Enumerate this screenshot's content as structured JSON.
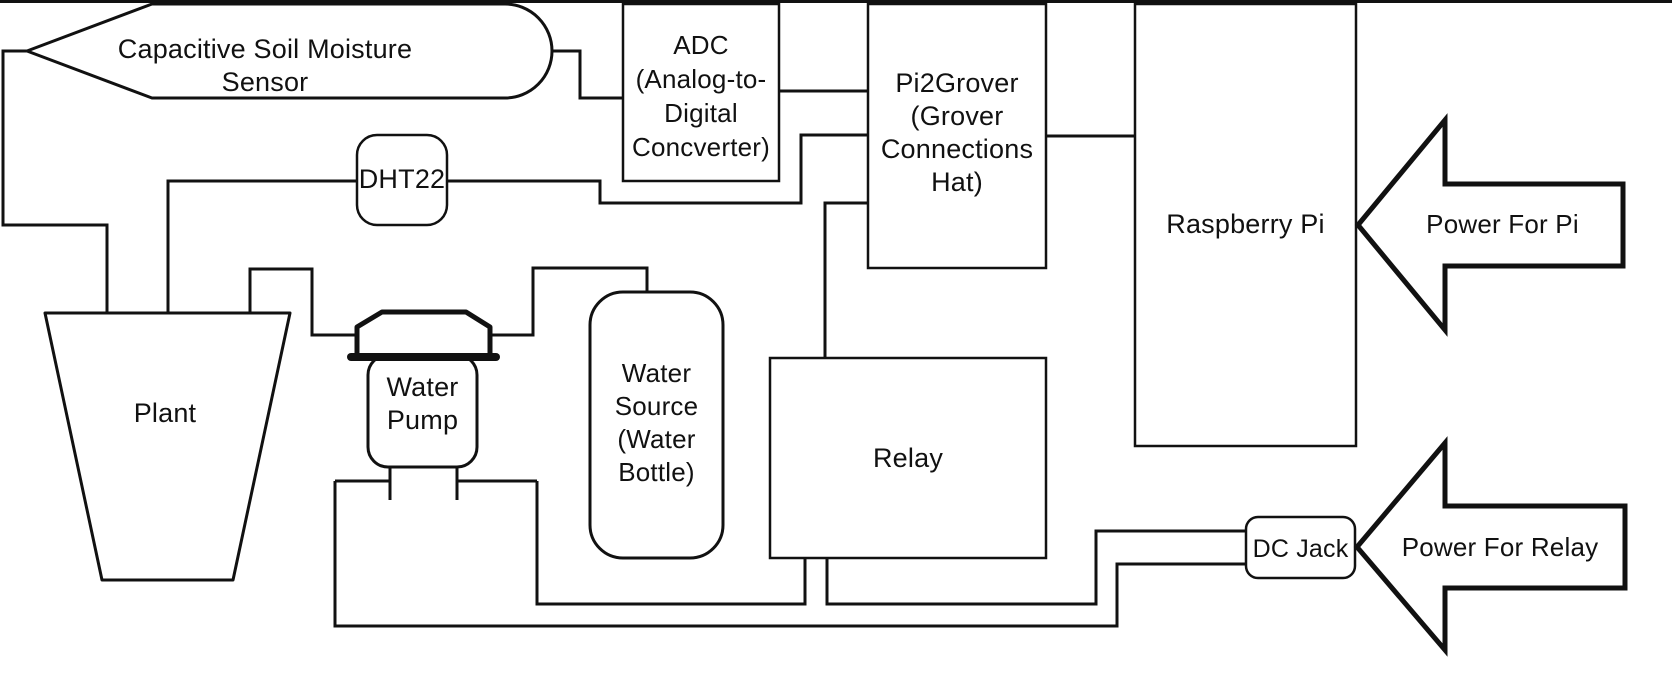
{
  "diagram": {
    "title_hint": "Raspberry Pi plant watering system block diagram",
    "colors": {
      "line": "#111111",
      "background": "#ffffff"
    },
    "nodes": {
      "sensor": {
        "label": "Capacitive Soil Moisture Sensor",
        "shape": "pennant-callout"
      },
      "adc": {
        "label": "ADC\n(Analog-to-\nDigital\nConcverter)",
        "shape": "rectangle"
      },
      "pi2grover": {
        "label": "Pi2Grover\n(Grover\nConnections\nHat)",
        "shape": "rectangle"
      },
      "dht22": {
        "label": "DHT22",
        "shape": "rounded-rectangle"
      },
      "raspberry_pi": {
        "label": "Raspberry Pi",
        "shape": "rectangle"
      },
      "power_pi": {
        "label": "Power For Pi",
        "shape": "block-arrow-left"
      },
      "plant": {
        "label": "Plant",
        "shape": "trapezoid-pot"
      },
      "water_pump": {
        "label": "Water\nPump",
        "shape": "capped-cylinder"
      },
      "water_source": {
        "label": "Water\nSource\n(Water\nBottle)",
        "shape": "rounded-rectangle"
      },
      "relay": {
        "label": "Relay",
        "shape": "rectangle"
      },
      "dc_jack": {
        "label": "DC Jack",
        "shape": "rounded-rectangle"
      },
      "power_relay": {
        "label": "Power For Relay",
        "shape": "block-arrow-left"
      }
    },
    "connections": [
      "sensor - plant",
      "sensor - adc",
      "adc - pi2grover",
      "dht22 - plant",
      "dht22 - pi2grover",
      "pi2grover - raspberry_pi",
      "pi2grover - relay",
      "power_pi - raspberry_pi",
      "plant - water_pump",
      "water_pump - water_source",
      "water_pump - relay",
      "water_pump - dc_jack",
      "relay - dc_jack",
      "power_relay - dc_jack"
    ]
  }
}
